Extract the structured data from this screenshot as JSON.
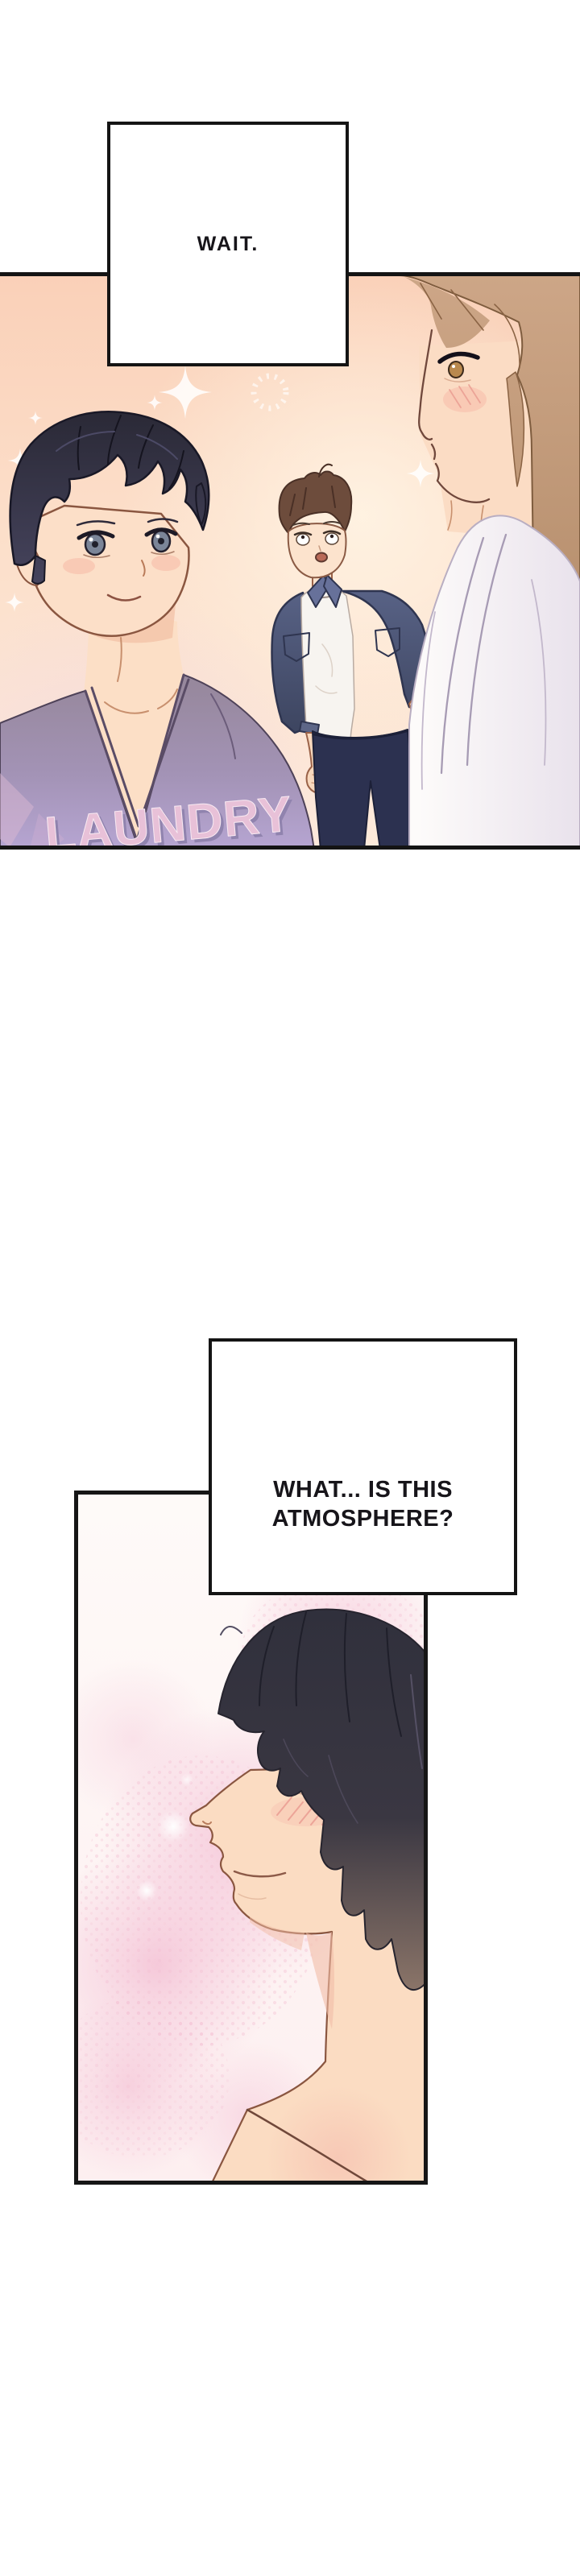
{
  "page": {
    "type": "webtoon-comic-page",
    "background": "#ffffff"
  },
  "captions": {
    "box1": {
      "text": "WAIT."
    },
    "box2": {
      "line1": "WHAT... IS THIS",
      "line2": "ATMOSPHERE?"
    }
  },
  "scene_panel": {
    "description": "three characters in a warm peach sparkling room",
    "shirt_text": "LAUNDRY",
    "colors": {
      "panel_border": "#141414",
      "background_peach_top": "#fad0b8",
      "background_peach_bottom": "#fdeadb",
      "sparkle": "#ffffff",
      "left_man_hair": "#2a2936",
      "left_man_shirt": "#a393b6",
      "shirt_print": "#e8c1d8",
      "middle_man_hair": "#6d4c3c",
      "middle_man_jacket": "#4e5774",
      "middle_man_pants": "#2c3150",
      "woman_hair": "#c9a281",
      "woman_robe": "#faf7f6",
      "skin": "#fbdcc2"
    }
  },
  "closeup_panel": {
    "description": "blushing dark-haired man in left-facing profile on pink watercolor background",
    "colors": {
      "panel_border": "#161616",
      "background_pink": "#fdf4f1",
      "blush_texture": "#f3bed3",
      "hair": "#33313d",
      "skin": "#fbdcc2"
    }
  }
}
